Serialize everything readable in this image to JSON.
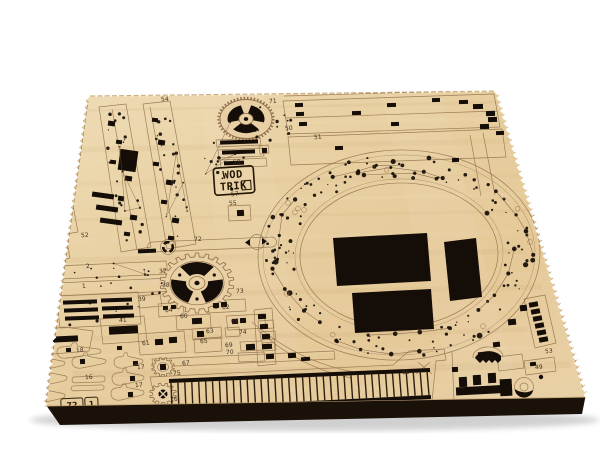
{
  "logo": {
    "line1": "WOD",
    "line2": "TRIK"
  },
  "sheet_id": {
    "left": "72",
    "right": "1"
  },
  "part_labels": [
    {
      "label": "71",
      "x": 273,
      "y": 103
    },
    {
      "label": "54",
      "x": 165,
      "y": 101
    },
    {
      "label": "50",
      "x": 289,
      "y": 130
    },
    {
      "label": "51",
      "x": 318,
      "y": 139
    },
    {
      "label": "59",
      "x": 237,
      "y": 164
    },
    {
      "label": "57",
      "x": 235,
      "y": 196
    },
    {
      "label": "55",
      "x": 233,
      "y": 205
    },
    {
      "label": "52",
      "x": 85,
      "y": 237
    },
    {
      "label": "72",
      "x": 198,
      "y": 241
    },
    {
      "label": "37",
      "x": 163,
      "y": 273
    },
    {
      "label": "2",
      "x": 88,
      "y": 268
    },
    {
      "label": "1",
      "x": 84,
      "y": 288
    },
    {
      "label": "38",
      "x": 166,
      "y": 287
    },
    {
      "label": "39",
      "x": 142,
      "y": 301
    },
    {
      "label": "73",
      "x": 240,
      "y": 293
    },
    {
      "label": "64",
      "x": 169,
      "y": 312
    },
    {
      "label": "60",
      "x": 184,
      "y": 318
    },
    {
      "label": "62",
      "x": 226,
      "y": 309
    },
    {
      "label": "68",
      "x": 235,
      "y": 323
    },
    {
      "label": "63",
      "x": 210,
      "y": 333
    },
    {
      "label": "74",
      "x": 243,
      "y": 334
    },
    {
      "label": "65",
      "x": 204,
      "y": 343
    },
    {
      "label": "69",
      "x": 229,
      "y": 347
    },
    {
      "label": "70",
      "x": 230,
      "y": 354
    },
    {
      "label": "40",
      "x": 44,
      "y": 341
    },
    {
      "label": "41",
      "x": 123,
      "y": 322
    },
    {
      "label": "61",
      "x": 146,
      "y": 345
    },
    {
      "label": "18",
      "x": 80,
      "y": 352
    },
    {
      "label": "19",
      "x": 46,
      "y": 372
    },
    {
      "label": "16",
      "x": 89,
      "y": 379
    },
    {
      "label": "17",
      "x": 141,
      "y": 369
    },
    {
      "label": "17",
      "x": 139,
      "y": 387
    },
    {
      "label": "67",
      "x": 186,
      "y": 365
    },
    {
      "label": "75",
      "x": 177,
      "y": 375
    },
    {
      "label": "76",
      "x": 174,
      "y": 401
    },
    {
      "label": "66",
      "x": 406,
      "y": 374
    },
    {
      "label": "53",
      "x": 549,
      "y": 353
    },
    {
      "label": "49",
      "x": 539,
      "y": 369
    }
  ],
  "colors": {
    "background": "#ffffff",
    "wood_base": "#e8d0a4",
    "wood_light": "#f2e3c3",
    "wood_dark": "#d9ba8a",
    "engrave": "#8f6f49",
    "engrave_dark": "#6b5236",
    "cut": "#150d07",
    "edge_band": "#1a1109",
    "label": "#3f3022",
    "logo_ink": "#241505"
  }
}
